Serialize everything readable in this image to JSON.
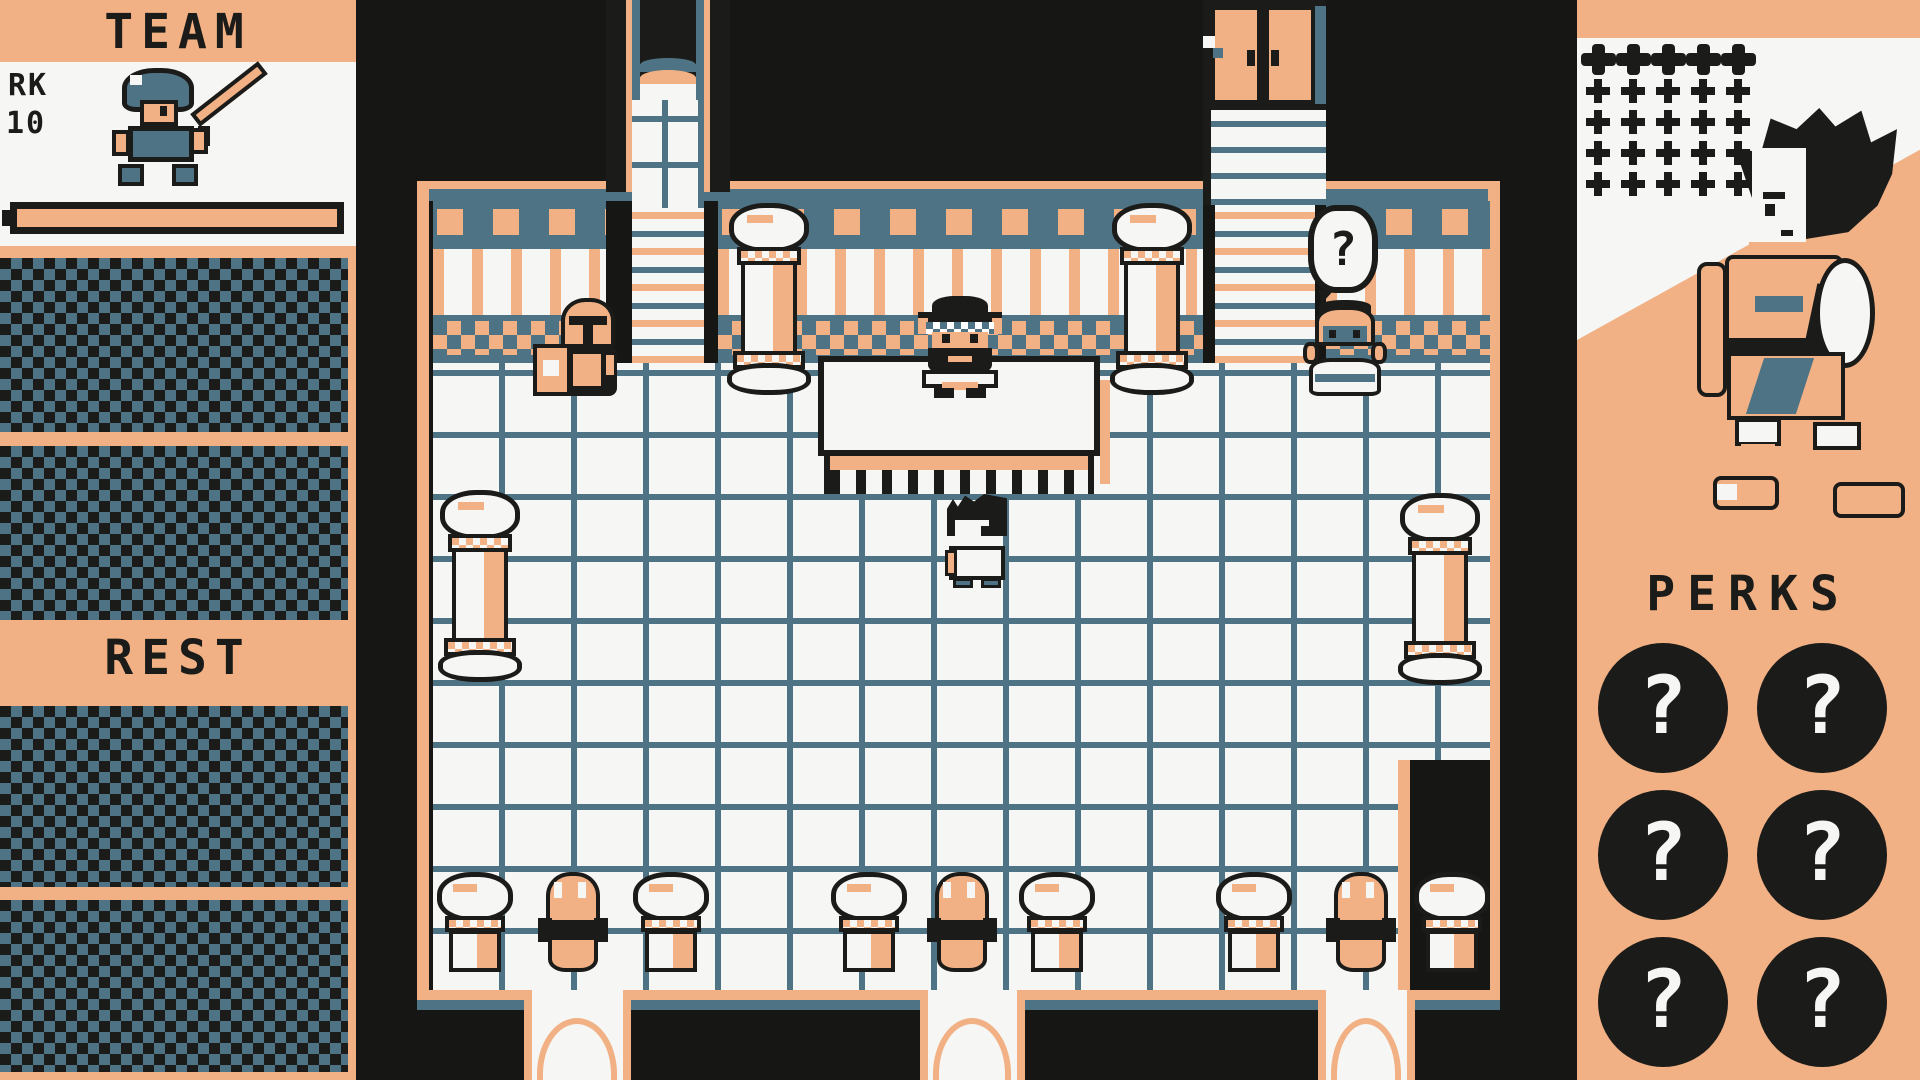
{
  "palette": {
    "peach": "#f1b185",
    "ink": "#1b1b19",
    "teal": "#4e7385",
    "paper": "#f6f6f4",
    "void": "#161614"
  },
  "left_sidebar": {
    "title": "TEAM",
    "unit": {
      "rank_label": "RK",
      "level": "10",
      "sprite": "knight-with-sword",
      "hp_fill_percent": 100
    },
    "rest_label": "REST",
    "empty_slot_count": 4
  },
  "map": {
    "sign_label": "?",
    "entities": {
      "player": "hero",
      "npc_behind_table": "bearded-shopkeeper",
      "npc_with_crate": "helmeted-porter",
      "npc_at_stool": "masked-vendor"
    },
    "decor": {
      "tall_pillars": 4,
      "stump_pillars": 6,
      "frog_statues": 3,
      "bottom_exits": 3,
      "top_doors": [
        "arched-stairway",
        "double-door"
      ]
    }
  },
  "right_sidebar": {
    "pips": {
      "big_row": 5,
      "small_rows": 4,
      "per_row": 5
    },
    "portrait": "fighter-woman",
    "perks_title": "PERKS",
    "perk_slots": [
      "?",
      "?",
      "?",
      "?",
      "?",
      "?"
    ]
  }
}
